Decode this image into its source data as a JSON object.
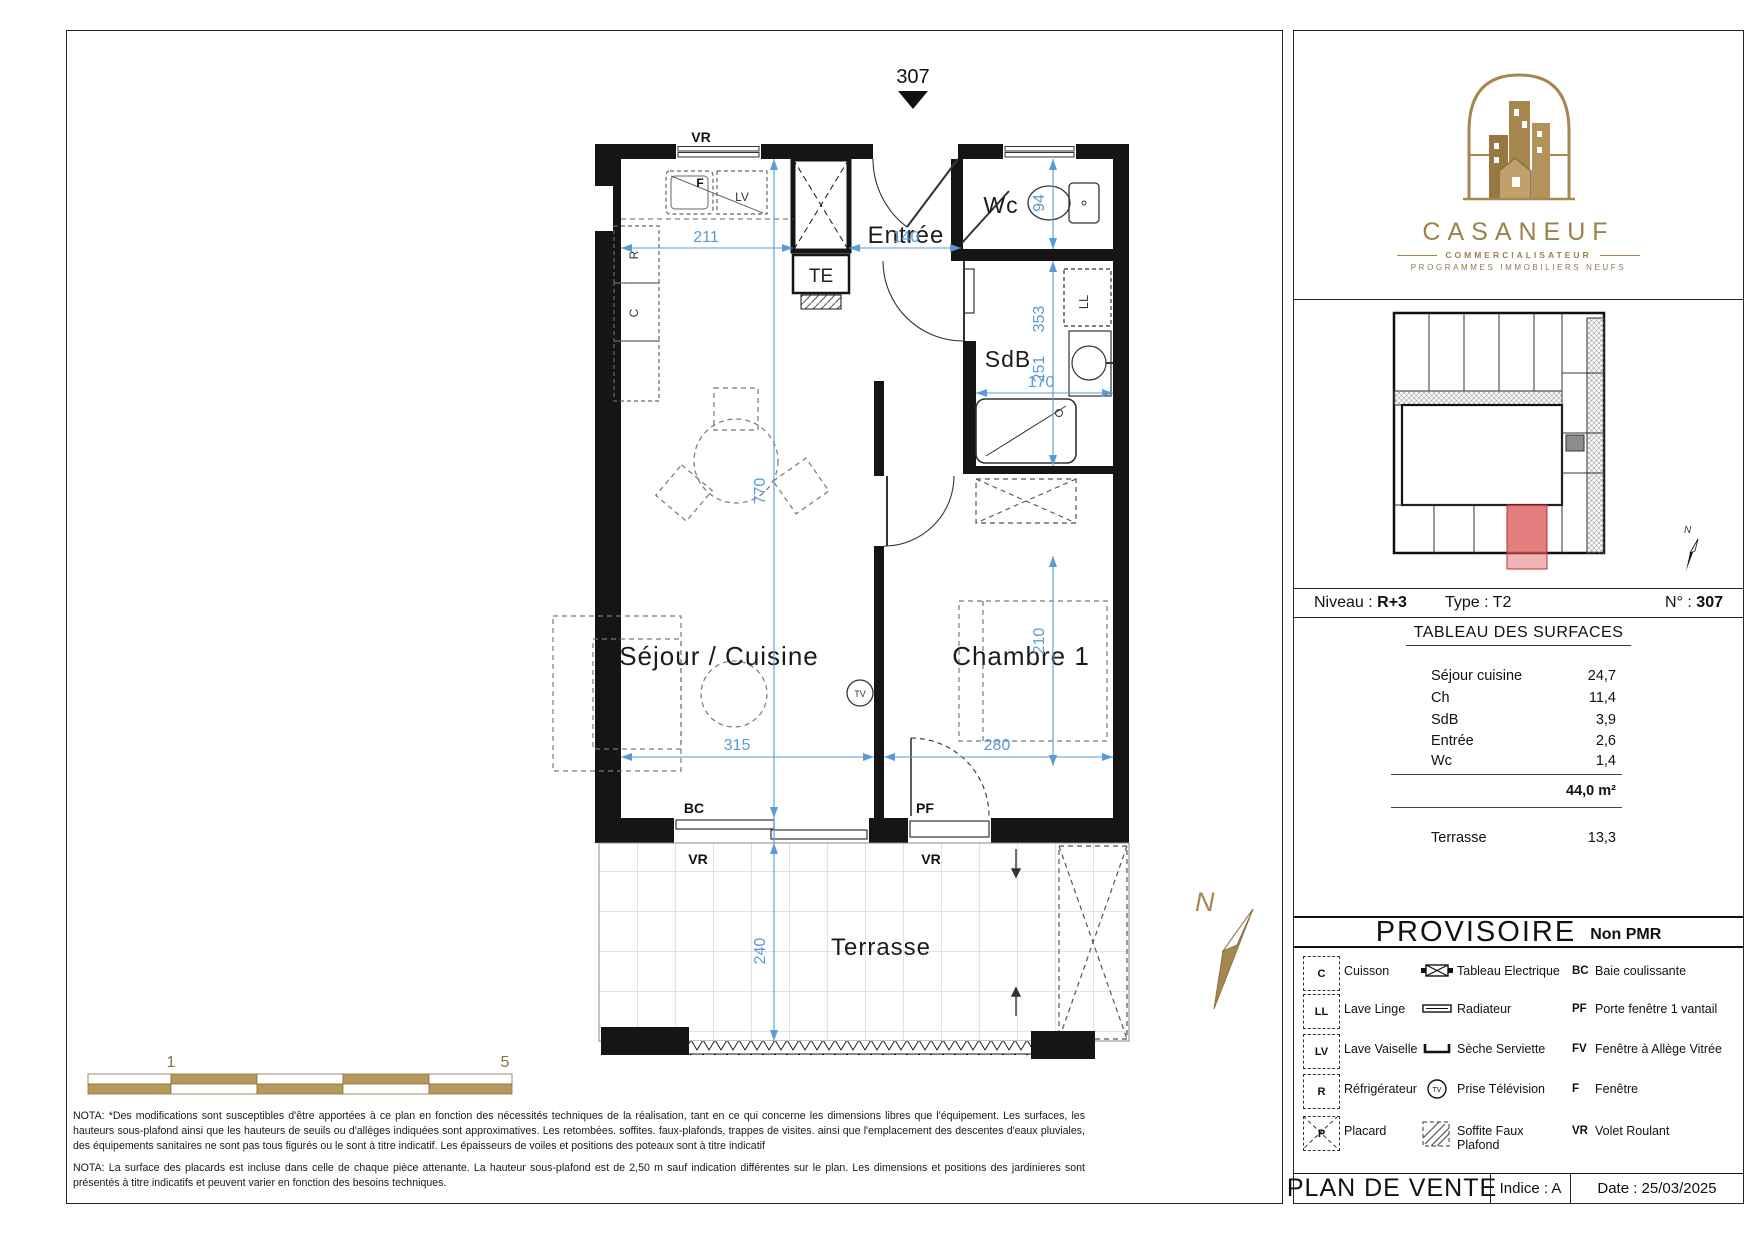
{
  "colors": {
    "dim_blue": "#5B9BD5",
    "gold": "#A6874F",
    "red_unit": "#DD5C5C",
    "wall": "#151515"
  },
  "plan": {
    "unit_marker": "307",
    "room_labels": {
      "sejour": "Séjour / Cuisine",
      "chambre": "Chambre 1",
      "entree": "Entrée",
      "wc": "Wc",
      "sdb": "SdB",
      "terrasse": "Terrasse"
    },
    "dimensions": {
      "d211": "211",
      "d140": "140",
      "d94": "94",
      "d353": "353",
      "d251": "251",
      "d170": "170",
      "d770": "770",
      "d210": "210",
      "d315": "315",
      "d280": "280",
      "d240": "240"
    },
    "annotations": {
      "vr_top": "VR",
      "bc": "BC",
      "vr_bc": "VR",
      "pf": "PF",
      "vr_pf": "VR",
      "te": "TE",
      "f": "F",
      "lv": "LV",
      "r": "R",
      "c": "C",
      "ll": "LL",
      "tv": "TV"
    },
    "north_letter": "N",
    "scale_bar": {
      "start": "1",
      "end": "5"
    }
  },
  "notes": {
    "nota1": "NOTA: *Des modifications sont susceptibles d'être apportées à ce plan en fonction des nécessités techniques de la réalisation, tant en ce qui concerne les dimensions libres que l'équipement. Les surfaces, les hauteurs sous-plafond ainsi que les hauteurs de seuils ou d'allèges indiquées sont approximatives. Les retombées. soffites. faux-plafonds, trappes de visites. ainsi que l'emplacement des descentes d'eaux pluviales, des équipements sanitaires ne sont pas tous figurés ou le sont à titre indicatif. Les épaisseurs de voiles et positions des poteaux sont à titre indicatif",
    "nota2": "NOTA: La surface des placards est incluse dans celle de chaque pièce attenante. La hauteur sous-plafond est de 2,50 m sauf indication différentes sur le plan. Les dimensions et positions des jardinieres sont présentés à titre indicatifs et peuvent varier en fonction des besoins techniques."
  },
  "panel": {
    "logo": {
      "name": "CASANEUF",
      "subtitle": "COMMERCIALISATEUR",
      "tagline": "PROGRAMMES  IMMOBILIERS  NEUFS"
    },
    "siteplan": {
      "north_letter": "N"
    },
    "info": {
      "niveau_label": "Niveau : ",
      "niveau_value": "R+3",
      "type_label": "Type : ",
      "type_value": "T2",
      "num_label": "N° : ",
      "num_value": "307"
    },
    "surfaces": {
      "title": "TABLEAU DES SURFACES",
      "rows": [
        {
          "label": "Séjour cuisine",
          "value": "24,7"
        },
        {
          "label": "Ch",
          "value": "11,4"
        },
        {
          "label": "SdB",
          "value": "3,9"
        },
        {
          "label": "Entrée",
          "value": "2,6"
        },
        {
          "label": "Wc",
          "value": "1,4"
        }
      ],
      "total": "44,0 m²",
      "terrace_label": "Terrasse",
      "terrace_value": "13,3"
    },
    "status": {
      "main": "PROVISOIRE",
      "pmr": "Non PMR"
    },
    "legend": {
      "rows": [
        {
          "code": "C",
          "code_label": "Cuisson",
          "icon_label": "Tableau Electrique",
          "abbr": "BC",
          "abbr_label": "Baie coulissante"
        },
        {
          "code": "LL",
          "code_label": "Lave Linge",
          "icon_label": "Radiateur",
          "abbr": "PF",
          "abbr_label": "Porte fenêtre 1 vantail"
        },
        {
          "code": "LV",
          "code_label": "Lave Vaiselle",
          "icon_label": "Sèche Serviette",
          "abbr": "FV",
          "abbr_label": "Fenêtre à Allège Vitrée"
        },
        {
          "code": "R",
          "code_label": "Réfrigérateur",
          "icon_label": "Prise Télévision",
          "abbr": "F",
          "abbr_label": "Fenêtre"
        },
        {
          "code": "P",
          "code_label": "Placard",
          "icon_label": "Soffite Faux Plafond",
          "abbr": "VR",
          "abbr_label": "Volet Roulant"
        }
      ]
    },
    "footer": {
      "title": "PLAN DE VENTE",
      "indice": "Indice : A",
      "date": "Date : 25/03/2025"
    }
  }
}
